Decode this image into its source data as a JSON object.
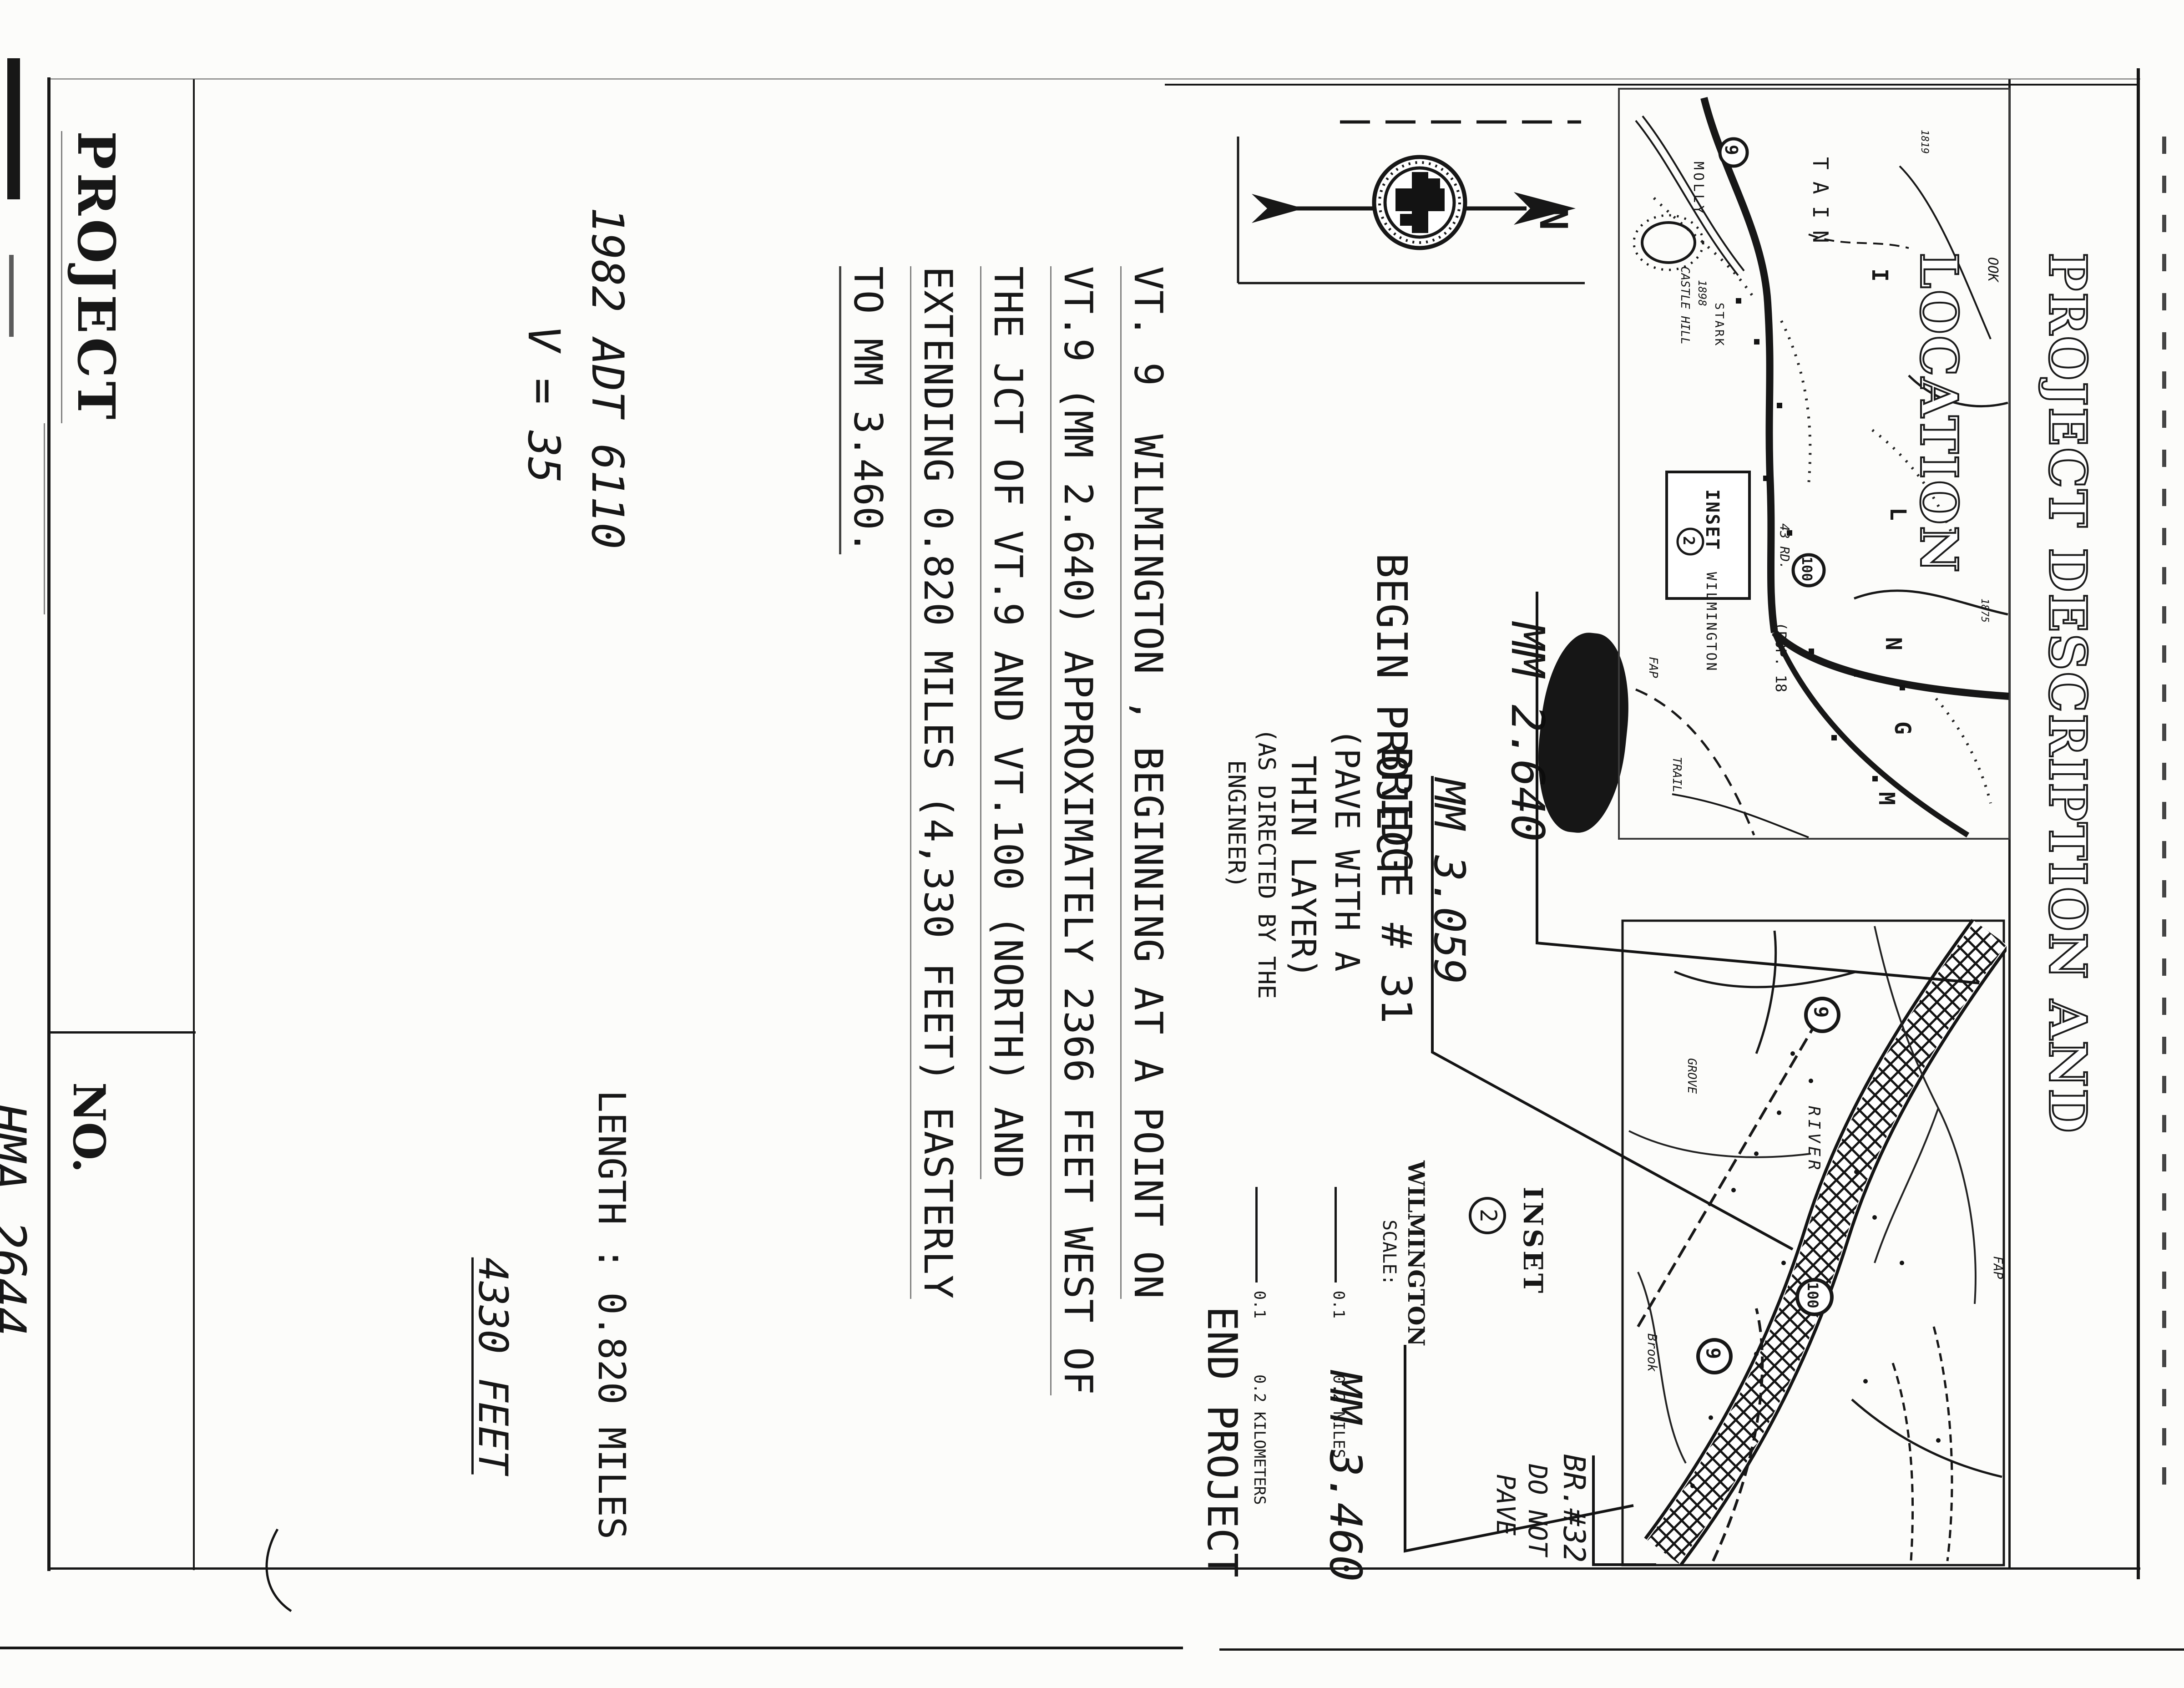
{
  "sheet": {
    "left_box": {
      "project_label": "PROJECT",
      "project_name": "WILMINGTON"
    },
    "number_box": {
      "no_label": "NO.",
      "project_number": "HMA 2644",
      "sheet_word": "SHEET",
      "sheet_no": "3",
      "of_word": "OF",
      "total_sheets": "18",
      "sheets_word": "SHEETS"
    },
    "traffic": {
      "line1": "1982 ADT 6110",
      "line2": "V = 35"
    },
    "length": {
      "line1": "LENGTH : 0.820 MILES",
      "line2": "4330 FEET"
    },
    "description": {
      "lines": [
        "VT. 9  WILMINGTON , BEGINNING AT A POINT ON",
        "VT.9 (MM 2.640) APPROXIMATELY 2366 FEET WEST OF",
        "THE JCT OF VT.9 AND VT.100 (NORTH) AND",
        "EXTENDING 0.820 MILES (4,330 FEET) EASTERLY",
        "TO MM 3.460."
      ]
    },
    "title_strip": "PROJECT  DESCRIPTION  AND  LOCATION",
    "north_label": "N",
    "begin": {
      "mm": "MM 2.640",
      "label": "BEGIN PROJECT"
    },
    "bridge31": {
      "mm": "MM 3.059",
      "lines": [
        "BRIDGE # 31",
        "(PAVE WITH A",
        "THIN LAYER)",
        "(AS DIRECTED BY THE",
        "ENGINEER)"
      ]
    },
    "end": {
      "mm": "MM 3.460",
      "label": "END PROJECT"
    },
    "br32": {
      "lines": [
        "BR.#32",
        "DO NOT",
        "PAVE"
      ]
    },
    "inset_legend": {
      "title": "INSET",
      "num": "2",
      "town": "WILMINGTON",
      "scale_label": "SCALE:",
      "miles": "0.1      0.2 MILES",
      "kilometers": "0.1      0.2 KILOMETERS"
    },
    "top_map": {
      "mountain_partial": "TAIN",
      "letter_i": "I",
      "letter_l": "L",
      "letter_m": "M",
      "letter_n": "N",
      "letter_g": "G",
      "molly": "MOLLY",
      "brook_partial": "OOK",
      "castle": "CASTLE HILL",
      "castle_year": "1898",
      "stark": "STARK",
      "road43": "43 RD.",
      "route9": "9",
      "route100": "100",
      "town": "WILMINGTON",
      "pop": "(POP. 18",
      "elev1": "1819",
      "elev2": "1875",
      "fap": "FAP",
      "trail": "TRAIL",
      "inset_label": "INSET",
      "inset_num": "2"
    },
    "bottom_map": {
      "river": "RIVER",
      "brook": "Brook",
      "fap": "FAP",
      "grove": "GROVE",
      "route9": "9",
      "route100": "100",
      "route9b": "9"
    }
  }
}
